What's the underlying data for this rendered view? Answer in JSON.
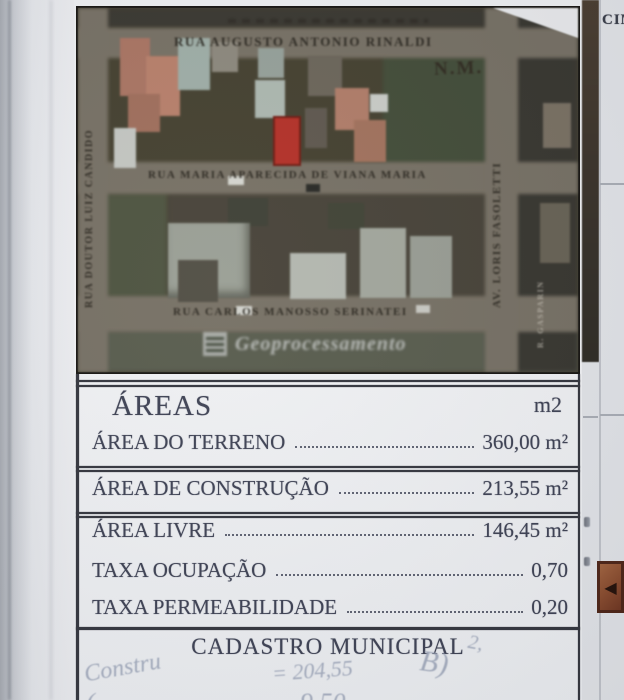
{
  "document": {
    "areas": {
      "title": "ÁREAS",
      "unit_header": "m2",
      "rows": [
        {
          "label": "ÁREA DO TERRENO",
          "value": "360,00 m²"
        },
        {
          "label": "ÁREA DE CONSTRUÇÃO",
          "value": "213,55 m²"
        },
        {
          "label": "ÁREA LIVRE",
          "value": "146,45 m²"
        },
        {
          "label": "TAXA OCUPAÇÃO",
          "value": "0,70"
        },
        {
          "label": "TAXA PERMEABILIDADE",
          "value": "0,20"
        }
      ],
      "section_footer": "CADASTRO MUNICIPAL"
    },
    "handwriting": {
      "after_footer": "2,",
      "left": "Constru",
      "center": "= 204,55",
      "right": "B)",
      "bottom_left": "(",
      "bottom_partial": "9,50"
    }
  },
  "map": {
    "compass_label": "N.M.",
    "watermark": "Geoprocessamento",
    "streets": {
      "top": "RUA AUGUSTO ANTONIO RINALDI",
      "middle": "RUA MARIA APARECIDA DE VIANA MARIA",
      "bottom": "RUA CARLOS MANOSSO SERINATEI",
      "left": "RUA DOUTOR LUIZ CANDIDO",
      "right": "AV. LORIS FASOLETTI",
      "far_right": "R. GASPARIN"
    }
  },
  "side_column": {
    "header_fragment": "CIM",
    "arrow_glyph": "◀"
  },
  "colors": {
    "highlight_lot": "#c9271b",
    "paper": "#f0f1f3",
    "ink": "#3e4254"
  }
}
